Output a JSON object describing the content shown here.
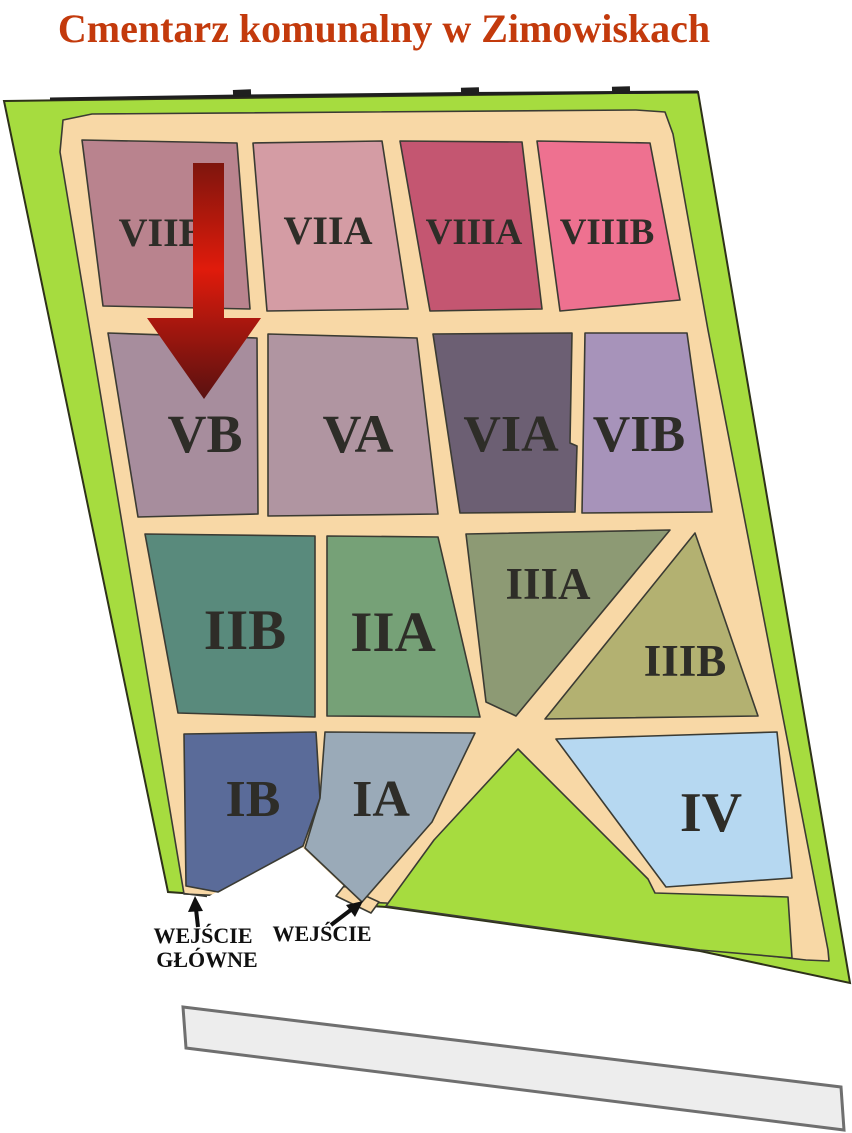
{
  "title": {
    "text": "Cmentarz komunalny w Zimowiskach",
    "color": "#C33A0C"
  },
  "map": {
    "grass_color": "#A6DC3F",
    "path_color": "#F8D8A6",
    "outline_color": "#3B3B33",
    "sections": [
      {
        "id": "VIIB",
        "label": "VIIB",
        "color": "#B9838E"
      },
      {
        "id": "VIIA",
        "label": "VIIA",
        "color": "#D49CA4"
      },
      {
        "id": "VIIIA",
        "label": "VIIIA",
        "color": "#C45671"
      },
      {
        "id": "VIIIB",
        "label": "VIIIB",
        "color": "#EE7190"
      },
      {
        "id": "VB",
        "label": "VB",
        "color": "#A78D9D"
      },
      {
        "id": "VA",
        "label": "VA",
        "color": "#B095A1"
      },
      {
        "id": "VIA",
        "label": "VIA",
        "color": "#6C5F73"
      },
      {
        "id": "VIB",
        "label": "VIB",
        "color": "#A793BA"
      },
      {
        "id": "IIB",
        "label": "IIB",
        "color": "#598A7C"
      },
      {
        "id": "IIA",
        "label": "IIA",
        "color": "#76A177"
      },
      {
        "id": "IIIA",
        "label": "IIIA",
        "color": "#8D9A74"
      },
      {
        "id": "IIIB",
        "label": "IIIB",
        "color": "#B3B171"
      },
      {
        "id": "IB",
        "label": "IB",
        "color": "#5A6B99"
      },
      {
        "id": "IA",
        "label": "IA",
        "color": "#9AAAB8"
      },
      {
        "id": "IV",
        "label": "IV",
        "color": "#B6D8F1"
      }
    ],
    "direction_arrow": {
      "top_color": "#7E150D",
      "mid_color": "#E01B0C",
      "tip_color": "#591110"
    },
    "entrances": [
      {
        "line1": "WEJŚCIE",
        "line2": "GŁÓWNE"
      },
      {
        "line1": "WEJŚCIE"
      }
    ]
  },
  "road": {
    "fill": "#EDEDED",
    "border": "#6F6F6F"
  }
}
